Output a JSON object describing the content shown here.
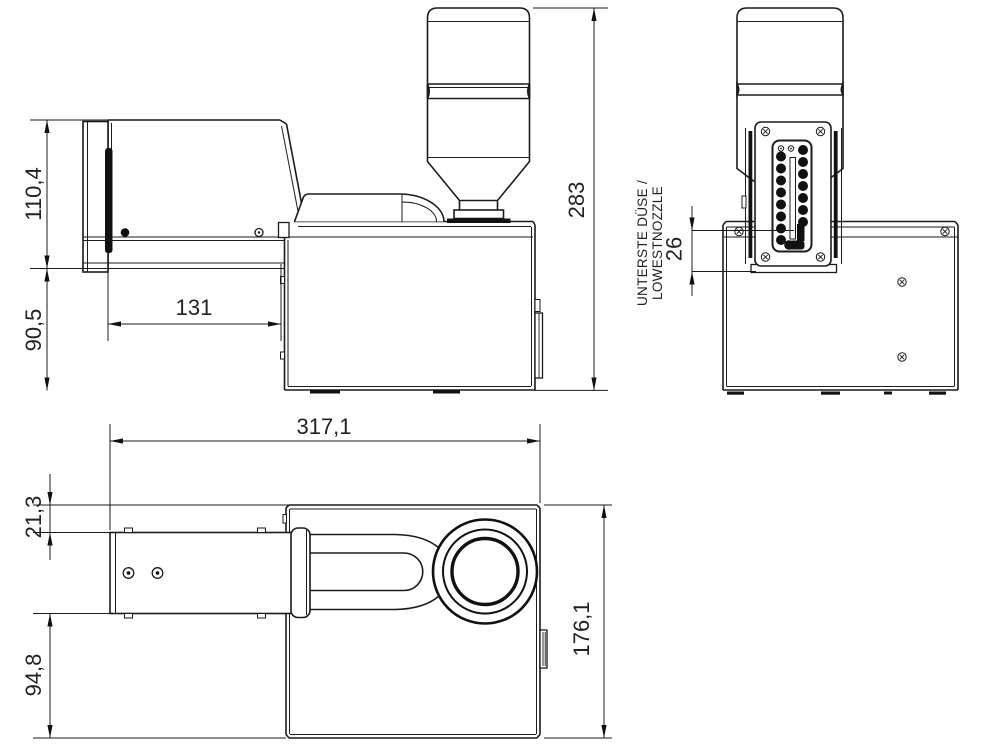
{
  "drawing": {
    "type": "technical-orthographic-views",
    "unit_style": "comma-decimal-mm",
    "dimensions": {
      "side": {
        "upper_height": "110,4",
        "lower_height": "90,5",
        "arm_length": "131",
        "total_height": "283"
      },
      "front": {
        "lowest_nozzle_offset": "26",
        "label_line1": "UNTERSTE DÜSE /",
        "label_line2": "LOWESTNOZZLE"
      },
      "top": {
        "total_length": "317,1",
        "arm_offset": "21,3",
        "body_depth": "94,8",
        "body_width": "176,1"
      }
    },
    "line_color": "#1b1b1b",
    "background_color": "#ffffff"
  }
}
